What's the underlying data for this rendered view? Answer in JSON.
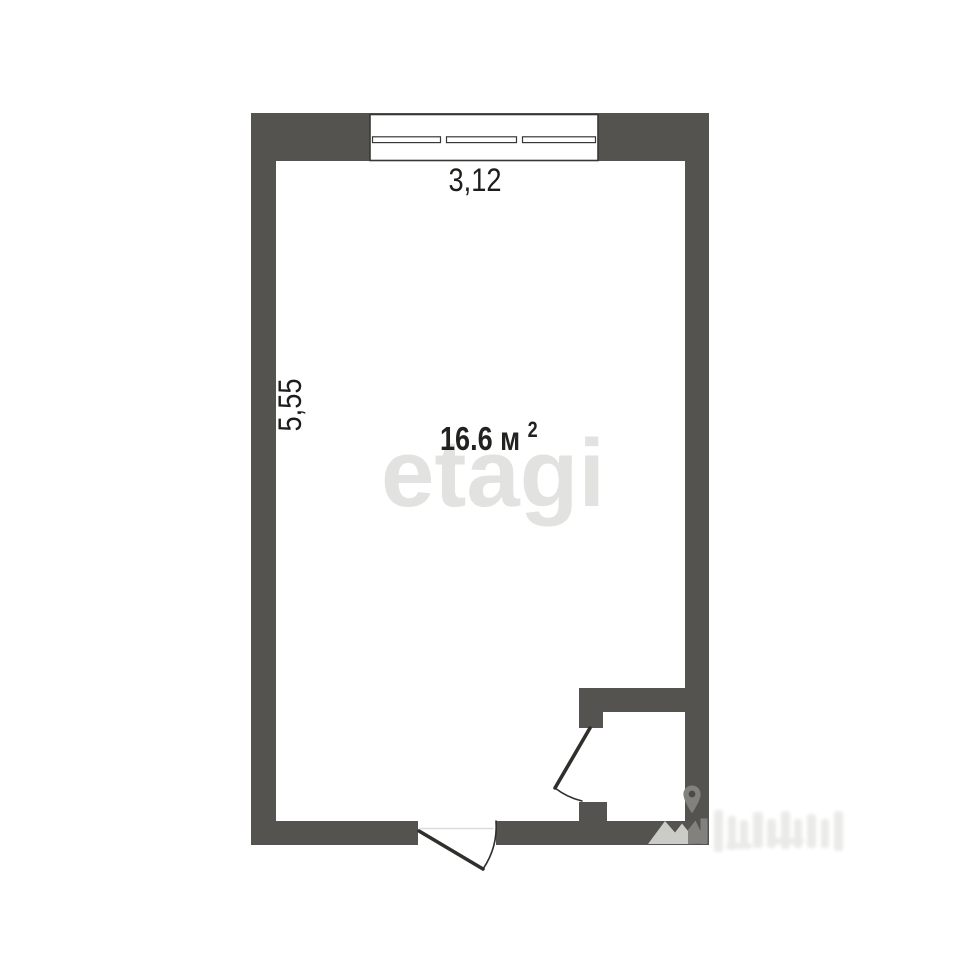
{
  "plan": {
    "top_dimension": "3,12",
    "left_dimension": "5,55",
    "room_area": "16.6 м",
    "room_area_superscript": "2"
  },
  "watermarks": {
    "brand": "etagi",
    "corner_logo_icons": [
      "location-pin-icon",
      "mountains-icon"
    ],
    "corner_text_legible": false
  },
  "colors": {
    "background": "#ffffff",
    "wall": "#54534f",
    "window_outline": "#393835",
    "door_line": "#2f2f2c",
    "threshold_line": "#dcdcd9",
    "dimension_text": "#1d1d1b",
    "area_text": "#222220",
    "brand_watermark": "#e2e2e0",
    "corner_watermark_light": "#cbcbc7",
    "corner_watermark_dark": "#82817d",
    "corner_watermark_faint": "#eaeae8"
  }
}
